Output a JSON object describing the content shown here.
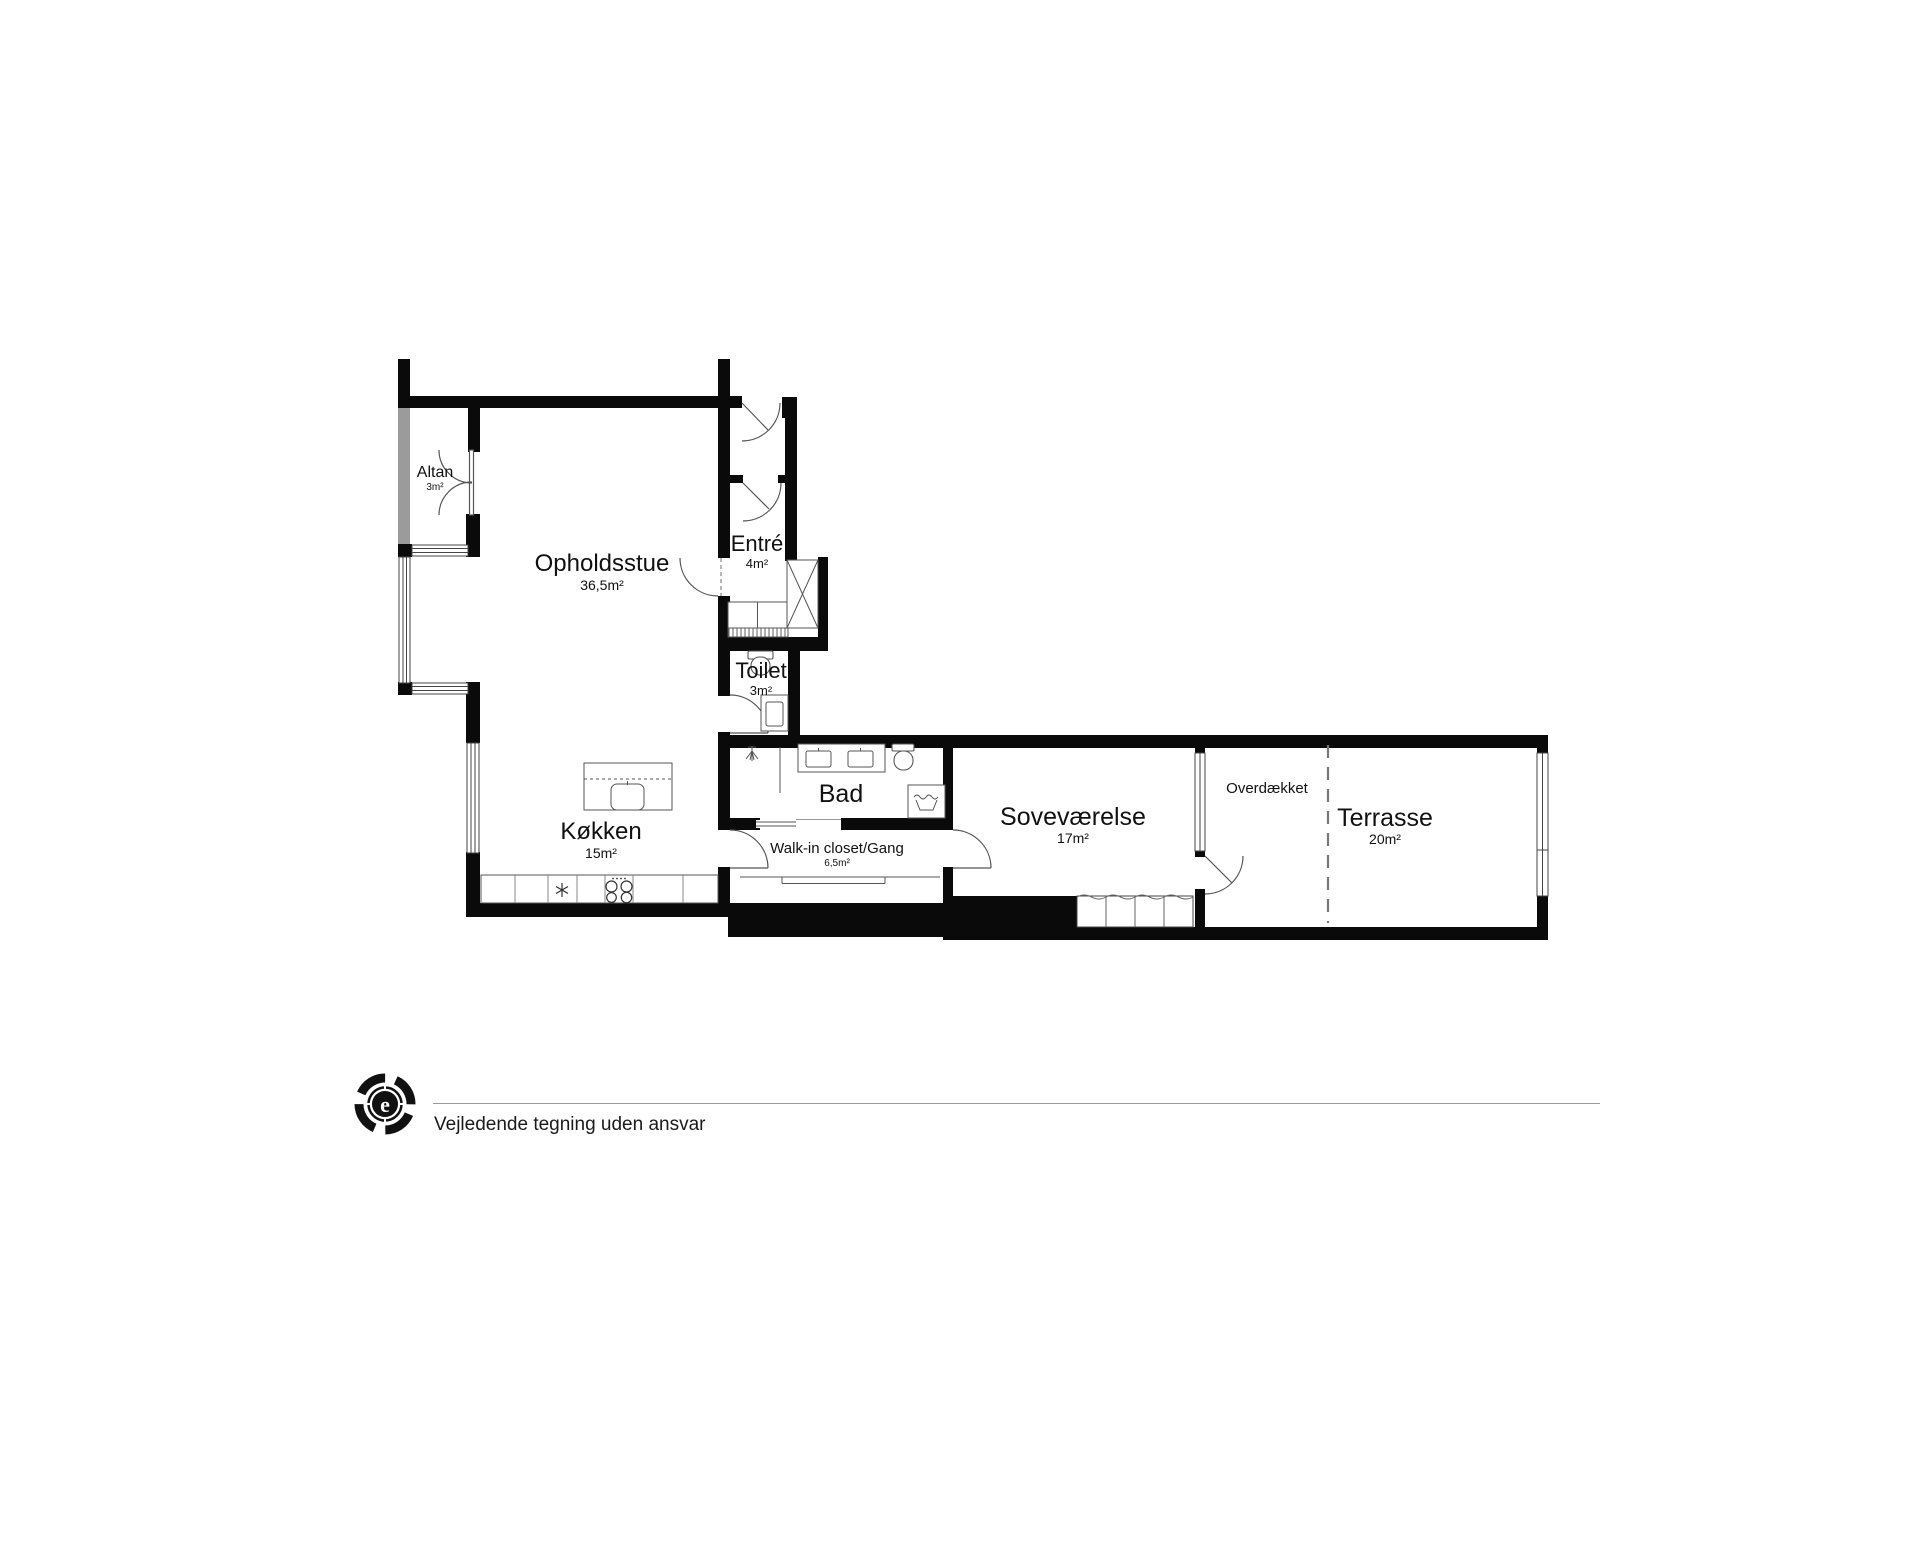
{
  "plan": {
    "rooms": {
      "altan": {
        "name": "Altan",
        "area": "3m²"
      },
      "opholdsstue": {
        "name": "Opholdsstue",
        "area": "36,5m²"
      },
      "entre": {
        "name": "Entré",
        "area": "4m²"
      },
      "toilet": {
        "name": "Toilet",
        "area": "3m²"
      },
      "bad": {
        "name": "Bad",
        "area": ""
      },
      "koekken": {
        "name": "Køkken",
        "area": "15m²"
      },
      "walkin": {
        "name": "Walk-in closet/Gang",
        "area": "6,5m²"
      },
      "sovevaerelse": {
        "name": "Soveværelse",
        "area": "17m²"
      },
      "overdaekket": {
        "name": "Overdækket",
        "area": ""
      },
      "terrasse": {
        "name": "Terrasse",
        "area": "20m²"
      }
    },
    "colors": {
      "wall": "#0a0a0a",
      "gray_wall": "#9b9b9b",
      "line": "#555555",
      "dash": "#777777"
    }
  },
  "footer": {
    "disclaimer": "Vejledende tegning uden ansvar",
    "logo_letter": "e"
  }
}
